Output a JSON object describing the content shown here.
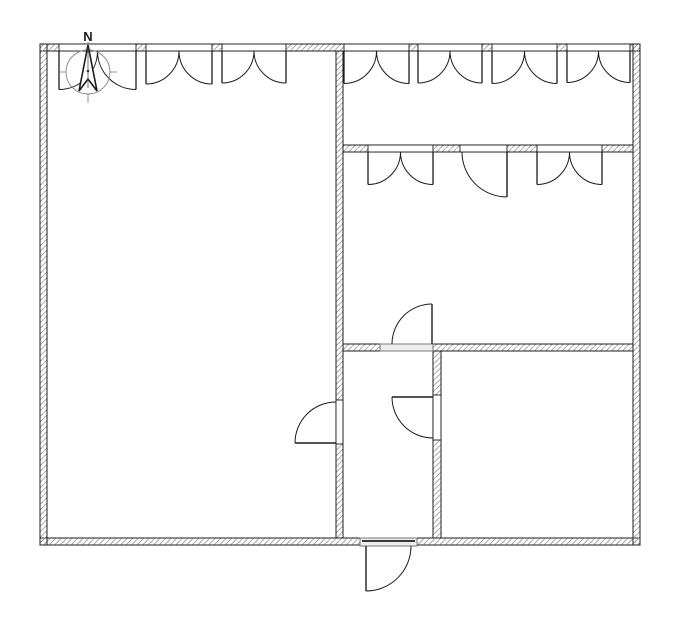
{
  "title": "floor-plan",
  "compass": {
    "label": "N",
    "circle": {
      "cx": 88,
      "cy": 72,
      "r": 22
    },
    "ticks": [
      [
        59,
        72,
        66,
        72
      ],
      [
        110,
        72,
        117,
        72
      ],
      [
        88,
        94,
        88,
        103
      ],
      [
        88,
        42,
        88,
        50
      ]
    ],
    "needle_points": "88,45 97,91 88,79 79,91",
    "axis": [
      88,
      48,
      88,
      88
    ],
    "dot": {
      "cx": 88,
      "cy": 71,
      "r": 1.3
    },
    "label_pos": {
      "x": 88,
      "y": 41
    }
  },
  "colors": {
    "line": "#1c1c1c",
    "hatch": "#999999",
    "wall_fill": "#ffffff",
    "threshold_fill": "#ededed",
    "threshold_stroke": "#777777",
    "threshold_accent": "#3a3a3a",
    "compass_line": "#8a8a8a"
  },
  "floorplan": {
    "canvas": {
      "width": 699,
      "height": 617
    },
    "walls": [
      {
        "name": "wall-top",
        "x": 40,
        "y": 44,
        "w": 600,
        "h": 7
      },
      {
        "name": "wall-bottom",
        "x": 40,
        "y": 538,
        "w": 600,
        "h": 7
      },
      {
        "name": "wall-left",
        "x": 40,
        "y": 44,
        "w": 7,
        "h": 501
      },
      {
        "name": "wall-right",
        "x": 633,
        "y": 44,
        "w": 7,
        "h": 501
      },
      {
        "name": "wall-interior-main",
        "x": 336,
        "y": 51,
        "w": 7,
        "h": 487
      },
      {
        "name": "wall-corridor",
        "x": 343,
        "y": 145,
        "w": 290,
        "h": 7
      },
      {
        "name": "wall-divider",
        "x": 343,
        "y": 344,
        "w": 290,
        "h": 7
      },
      {
        "name": "wall-small-room-east",
        "x": 433,
        "y": 351,
        "w": 8,
        "h": 187
      }
    ],
    "window_bands": [
      {
        "x": 59,
        "y": 44,
        "w": 77,
        "h": 7
      },
      {
        "x": 146,
        "y": 44,
        "w": 66,
        "h": 7
      },
      {
        "x": 222,
        "y": 44,
        "w": 64,
        "h": 7
      },
      {
        "x": 344,
        "y": 44,
        "w": 65,
        "h": 7
      },
      {
        "x": 418,
        "y": 44,
        "w": 64,
        "h": 7
      },
      {
        "x": 492,
        "y": 44,
        "w": 65,
        "h": 7
      },
      {
        "x": 567,
        "y": 44,
        "w": 63,
        "h": 7
      },
      {
        "x": 368,
        "y": 145,
        "w": 65,
        "h": 7
      },
      {
        "x": 537,
        "y": 145,
        "w": 65,
        "h": 7
      }
    ],
    "openings": [
      {
        "name": "opening-corridor-door",
        "x": 460,
        "y": 145,
        "w": 47,
        "h": 7
      },
      {
        "name": "opening-small-room-west",
        "x": 336,
        "y": 400,
        "w": 7,
        "h": 44
      },
      {
        "name": "opening-small-room-east",
        "x": 433,
        "y": 395,
        "w": 8,
        "h": 45
      }
    ],
    "thresholds": [
      {
        "name": "threshold-divider-door",
        "x": 380,
        "y": 344,
        "w": 53,
        "h": 7
      },
      {
        "name": "threshold-entrance-door",
        "x": 360,
        "y": 538,
        "w": 57,
        "h": 8
      }
    ],
    "threshold_accents": [
      [
        362,
        541,
        415,
        541
      ]
    ],
    "windows": [
      {
        "x1": 59,
        "x2": 136,
        "y": 51
      },
      {
        "x1": 146,
        "x2": 212,
        "y": 51
      },
      {
        "x1": 222,
        "x2": 286,
        "y": 51
      },
      {
        "x1": 344,
        "x2": 409,
        "y": 51
      },
      {
        "x1": 418,
        "x2": 482,
        "y": 51
      },
      {
        "x1": 492,
        "x2": 557,
        "y": 51
      },
      {
        "x1": 567,
        "x2": 630,
        "y": 51
      },
      {
        "x1": 368,
        "x2": 433,
        "y": 152
      },
      {
        "x1": 537,
        "x2": 602,
        "y": 152
      }
    ],
    "doors": [
      {
        "name": "door-corridor",
        "leaf": [
          507,
          152,
          507,
          197
        ],
        "arc": {
          "sx": 462,
          "sy": 152,
          "ex": 507,
          "ey": 197,
          "r": 45,
          "sweep": 0
        }
      },
      {
        "name": "door-upper-room",
        "leaf": [
          432,
          344,
          432,
          304
        ],
        "arc": {
          "sx": 392,
          "sy": 344,
          "ex": 432,
          "ey": 304,
          "r": 40,
          "sweep": 1
        }
      },
      {
        "name": "door-small-room-east",
        "leaf": [
          433,
          397,
          392,
          397
        ],
        "arc": {
          "sx": 392,
          "sy": 397,
          "ex": 433,
          "ey": 438,
          "r": 41,
          "sweep": 0
        }
      },
      {
        "name": "door-small-room-west",
        "leaf": [
          336,
          443,
          295,
          443
        ],
        "arc": {
          "sx": 295,
          "sy": 443,
          "ex": 336,
          "ey": 402,
          "r": 41,
          "sweep": 1
        }
      },
      {
        "name": "door-entrance",
        "leaf": [
          366,
          546,
          366,
          591
        ],
        "arc": {
          "sx": 366,
          "sy": 591,
          "ex": 411,
          "ey": 546,
          "r": 45,
          "sweep": 0
        }
      }
    ]
  }
}
